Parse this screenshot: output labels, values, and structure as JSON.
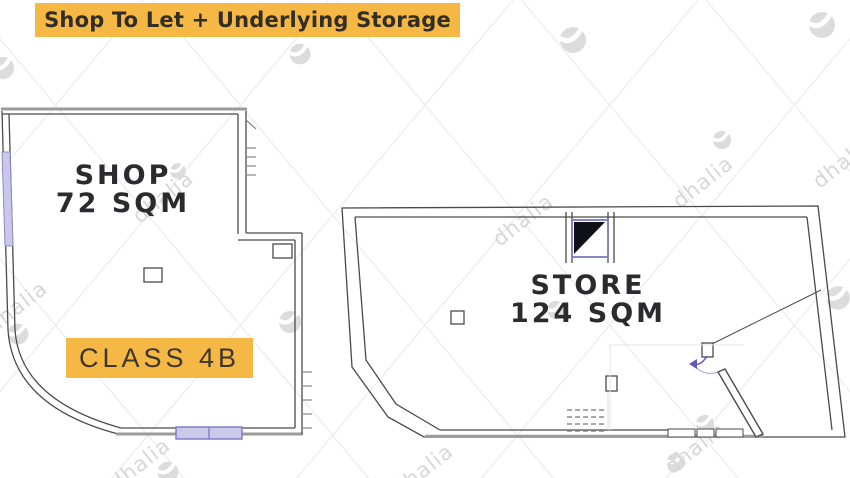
{
  "title": "Shop To Let + Underlying Storage",
  "shop": {
    "name": "SHOP",
    "area": "72 SQM",
    "class_label": "CLASS 4B"
  },
  "store": {
    "name": "STORE",
    "area": "124 SQM"
  },
  "watermark": {
    "brand": "dhalia"
  },
  "colors": {
    "accent_yellow": "#F6B845",
    "wall_dark": "#4a4a4a",
    "wall_gray": "#9b9b9b",
    "window_lavender": "#cbc7e9",
    "shaft_border": "#7d78c2",
    "watermark_gray": "#d7d7d7",
    "text_dark": "#2b2a2e"
  }
}
